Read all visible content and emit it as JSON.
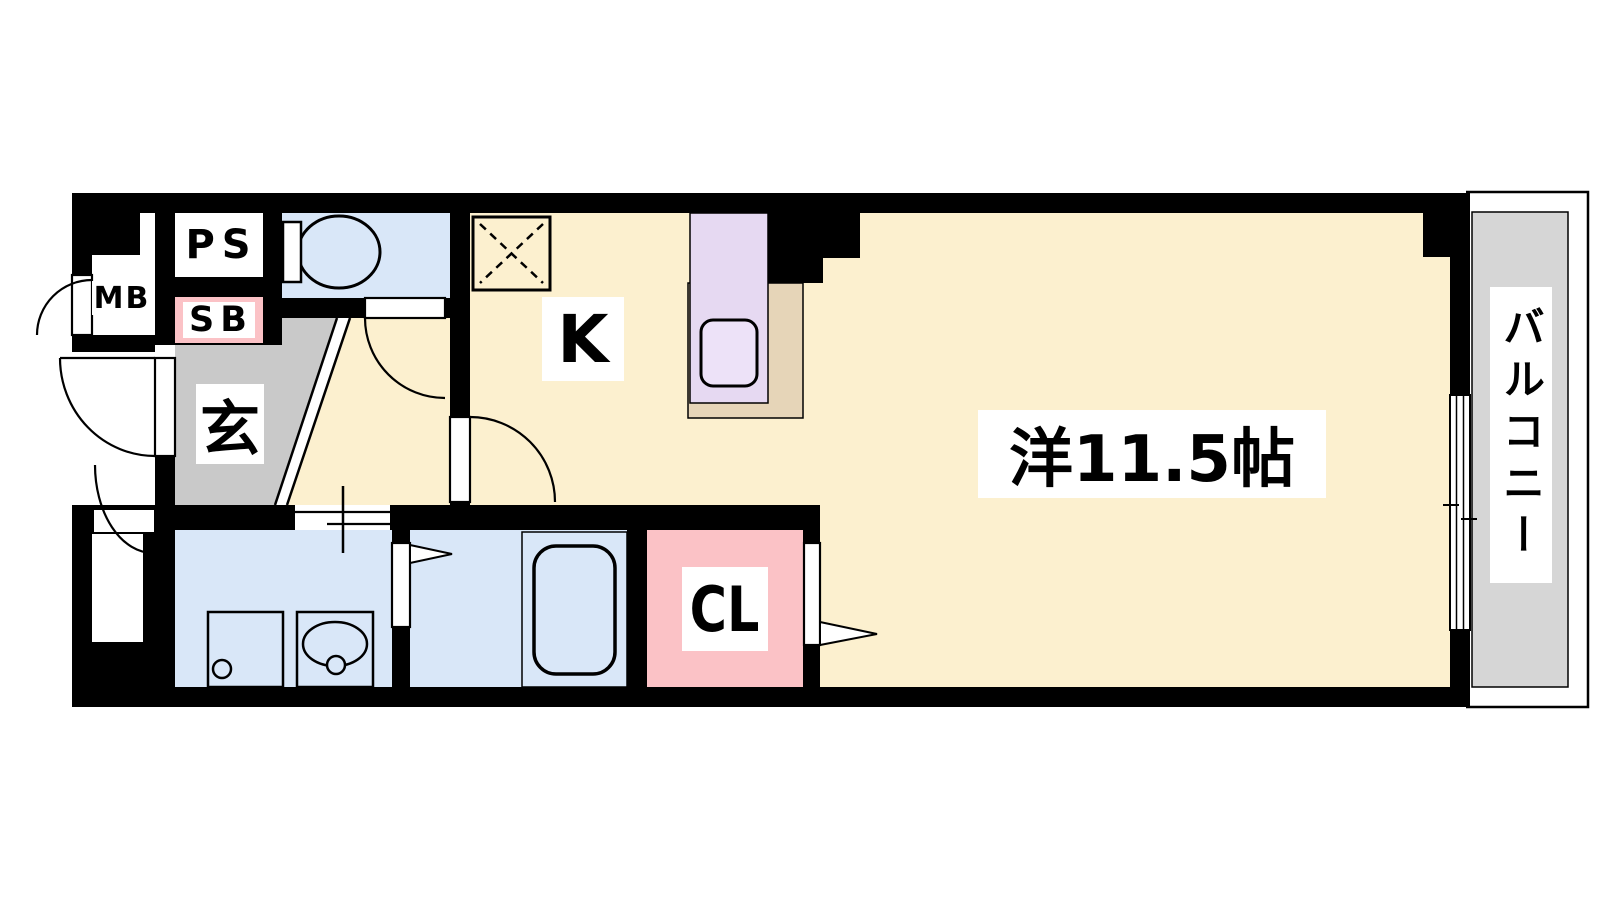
{
  "floorplan": {
    "labels": {
      "meter_box": "MB",
      "pipe_space": "PS",
      "shoe_box": "SB",
      "entrance": "玄",
      "kitchen": "K",
      "main_room": "洋11.5帖",
      "closet": "CL",
      "balcony": "バルコニー"
    },
    "colors": {
      "wall": "#000000",
      "floor_main": "#FCF0CF",
      "floor_entrance": "#C9C9C9",
      "floor_wet_area": "#D9E7F8",
      "floor_closet": "#FBC2C6",
      "shoe_box_accent": "#FBC2C6",
      "kitchen_counter": "#E6D9F2",
      "kitchen_sink": "#EDE2F8",
      "counter_base": "#E6D5B8",
      "balcony_floor": "#D6D6D6"
    }
  }
}
